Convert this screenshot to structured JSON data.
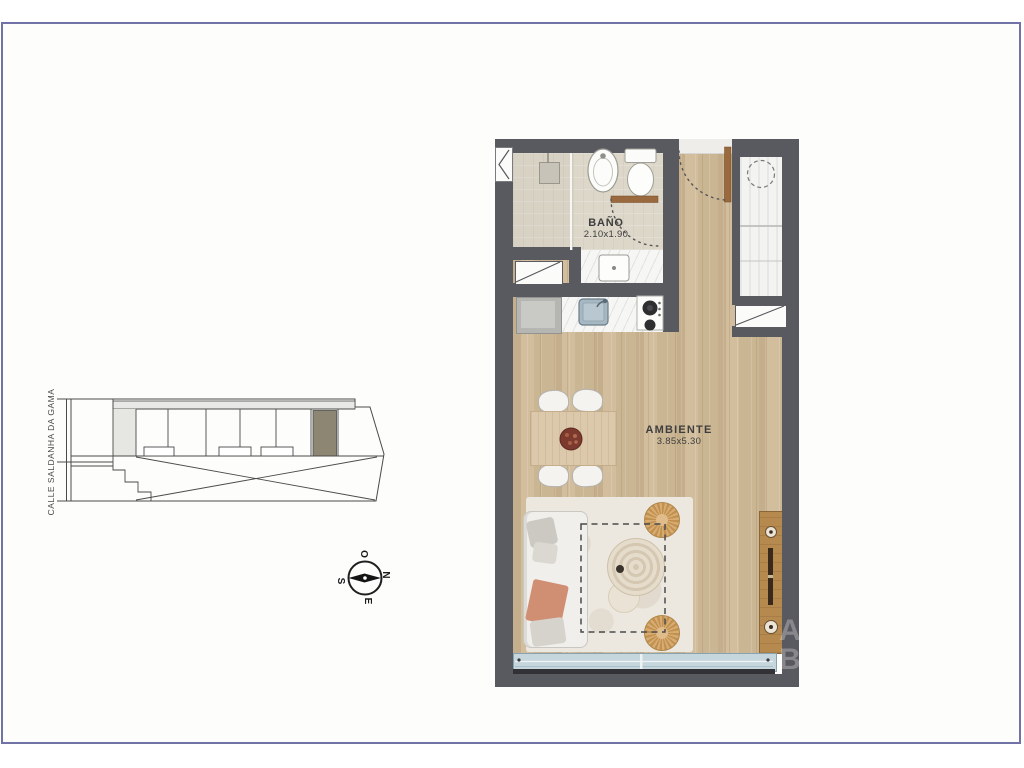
{
  "page": {
    "frame_border_color": "#7173a6"
  },
  "floor_plan": {
    "bathroom_label": "BAÑO",
    "bathroom_dimensions": "2.10x1.90",
    "room_label": "AMBIENTE",
    "room_dimensions": "3.85x5.30"
  },
  "key_plan": {
    "street_label": "CALLE SALDANHA DA GAMA",
    "highlighted_unit_color": "#8d8672"
  },
  "compass": {
    "top": "O",
    "right": "N",
    "left": "S",
    "bottom": "E"
  },
  "watermark": {
    "line1": "A",
    "line2": "B"
  },
  "colors": {
    "wall": "#595960",
    "wood_floor": "#cfbb99",
    "bathroom_floor": "#ddd7c9",
    "window_glass": "#c6d6dd",
    "accent_wood": "#b6894f"
  }
}
